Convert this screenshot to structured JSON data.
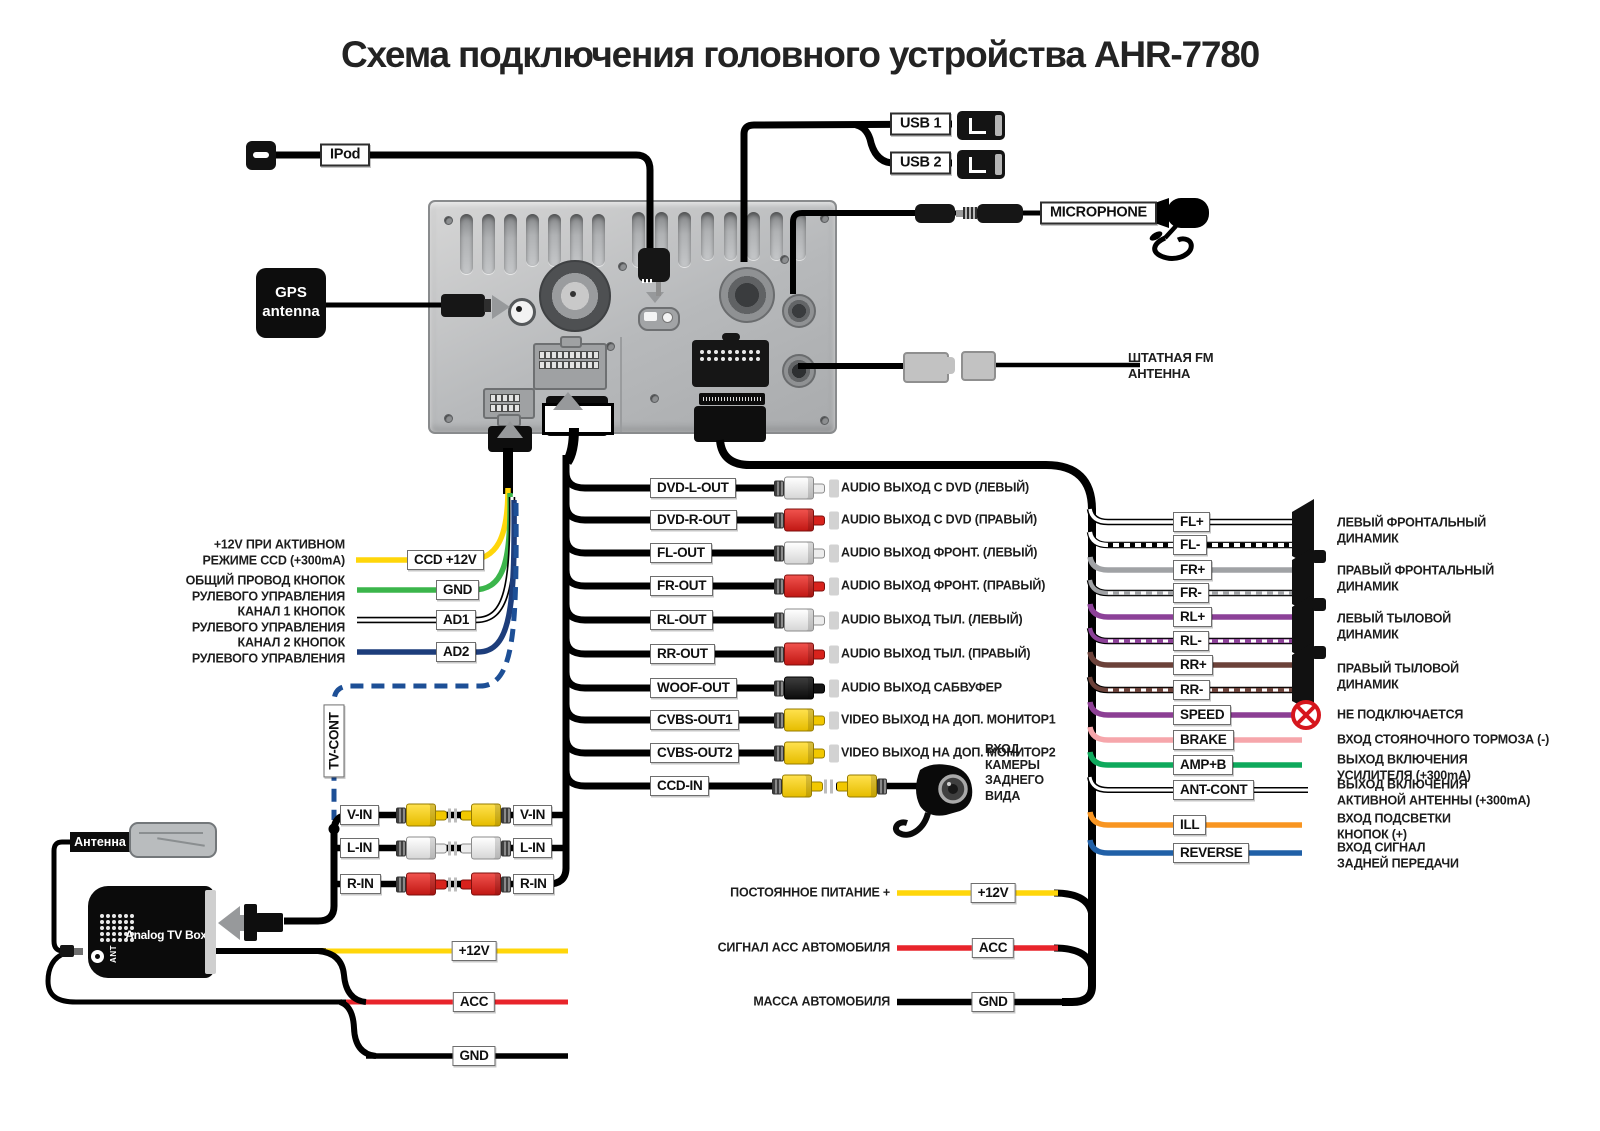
{
  "title": "Схема подключения головного устройства AHR-7780",
  "colors": {
    "yellow": "#ffd60a",
    "green": "#3bb54b",
    "navy": "#1d3d7b",
    "dashblue": "#1d4f96",
    "red": "#e8242b",
    "graywire": "#a0a2a5",
    "purple": "#8c4198",
    "brown": "#6b4139",
    "speed": "#8c3f94",
    "pink": "#f6a6ab",
    "amp": "#0ea95c",
    "orange": "#f89521",
    "reverse": "#2060a7",
    "rcared": "#d8221c",
    "rcayellow": "#f2c800"
  },
  "top": {
    "ipod": "IPod",
    "usb1": "USB 1",
    "usb2": "USB 2",
    "microphone": "MICROPHONE",
    "gps": "GPS\nantenna",
    "fm": "ШТАТНАЯ FM\nАНТЕННА"
  },
  "left_rows": [
    {
      "label": "CCD +12V",
      "desc": "+12V ПРИ АКТИВНОМ\nРЕЖИМЕ CCD (+300mA)"
    },
    {
      "label": "GND",
      "desc": "ОБЩИЙ ПРОВОД КНОПОК\nРУЛЕВОГО УПРАВЛЕНИЯ"
    },
    {
      "label": "AD1",
      "desc": "КАНАЛ 1 КНОПОК\nРУЛЕВОГО УПРАВЛЕНИЯ"
    },
    {
      "label": "AD2",
      "desc": "КАНАЛ 2 КНОПОК\nРУЛЕВОГО УПРАВЛЕНИЯ"
    }
  ],
  "tv_cont": "TV-CONT",
  "mid_rows": [
    {
      "label": "DVD-L-OUT",
      "desc": "AUDIO ВЫХОД С DVD (ЛЕВЫЙ)"
    },
    {
      "label": "DVD-R-OUT",
      "desc": "AUDIO ВЫХОД С DVD (ПРАВЫЙ)"
    },
    {
      "label": "FL-OUT",
      "desc": "AUDIO ВЫХОД ФРОНТ. (ЛЕВЫЙ)"
    },
    {
      "label": "FR-OUT",
      "desc": "AUDIO ВЫХОД ФРОНТ. (ПРАВЫЙ)"
    },
    {
      "label": "RL-OUT",
      "desc": "AUDIO ВЫХОД ТЫЛ. (ЛЕВЫЙ)"
    },
    {
      "label": "RR-OUT",
      "desc": "AUDIO ВЫХОД ТЫЛ. (ПРАВЫЙ)"
    },
    {
      "label": "WOOF-OUT",
      "desc": "AUDIO ВЫХОД САБВУФЕР"
    },
    {
      "label": "CVBS-OUT1",
      "desc": "VIDEO ВЫХОД НА ДОП. МОНИТОР1"
    },
    {
      "label": "CVBS-OUT2",
      "desc": "VIDEO ВЫХОД НА ДОП. МОНИТОР2"
    },
    {
      "label": "CCD-IN",
      "desc": "ВХОД\nКАМЕРЫ\nЗАДНЕГО\nВИДА"
    }
  ],
  "right_rows": [
    {
      "label": "FL+"
    },
    {
      "label": "FL-"
    },
    {
      "label": "FR+"
    },
    {
      "label": "FR-"
    },
    {
      "label": "RL+"
    },
    {
      "label": "RL-"
    },
    {
      "label": "RR+"
    },
    {
      "label": "RR-"
    },
    {
      "label": "SPEED",
      "desc": "НЕ ПОДКЛЮЧАЕТСЯ"
    },
    {
      "label": "BRAKE",
      "desc": "ВХОД СТОЯНОЧНОГО ТОРМОЗА (-)"
    },
    {
      "label": "AMP+B",
      "desc": "ВЫХОД ВКЛЮЧЕНИЯ\nУСИЛИТЕЛЯ (+300mA)"
    },
    {
      "label": "ANT-CONT",
      "desc": "ВЫХОД ВКЛЮЧЕНИЯ\nАКТИВНОЙ АНТЕННЫ (+300mA)"
    },
    {
      "label": "ILL",
      "desc": "ВХОД ПОДСВЕТКИ\nКНОПОК (+)"
    },
    {
      "label": "REVERSE",
      "desc": "ВХОД СИГНАЛ\nЗАДНЕЙ ПЕРЕДАЧИ"
    }
  ],
  "speaker_descs": [
    {
      "text": "ЛЕВЫЙ ФРОНТАЛЬНЫЙ\nДИНАМИК"
    },
    {
      "text": "ПРАВЫЙ ФРОНТАЛЬНЫЙ\nДИНАМИК"
    },
    {
      "text": "ЛЕВЫЙ ТЫЛОВОЙ\nДИНАМИК"
    },
    {
      "text": "ПРАВЫЙ ТЫЛОВОЙ\nДИНАМИК"
    }
  ],
  "av_rows": [
    {
      "label": "V-IN"
    },
    {
      "label": "L-IN"
    },
    {
      "label": "R-IN"
    }
  ],
  "tv_box": {
    "antenna": "Антенна",
    "name": "Analog TV Box",
    "ant": "ANT",
    "rows": [
      {
        "label": "+12V"
      },
      {
        "label": "ACC"
      },
      {
        "label": "GND"
      }
    ]
  },
  "power_rows": [
    {
      "label": "+12V",
      "desc": "ПОСТОЯННОЕ ПИТАНИЕ +"
    },
    {
      "label": "ACC",
      "desc": "СИГНАЛ ACC АВТОМОБИЛЯ"
    },
    {
      "label": "GND",
      "desc": "МАССА АВТОМОБИЛЯ"
    }
  ]
}
